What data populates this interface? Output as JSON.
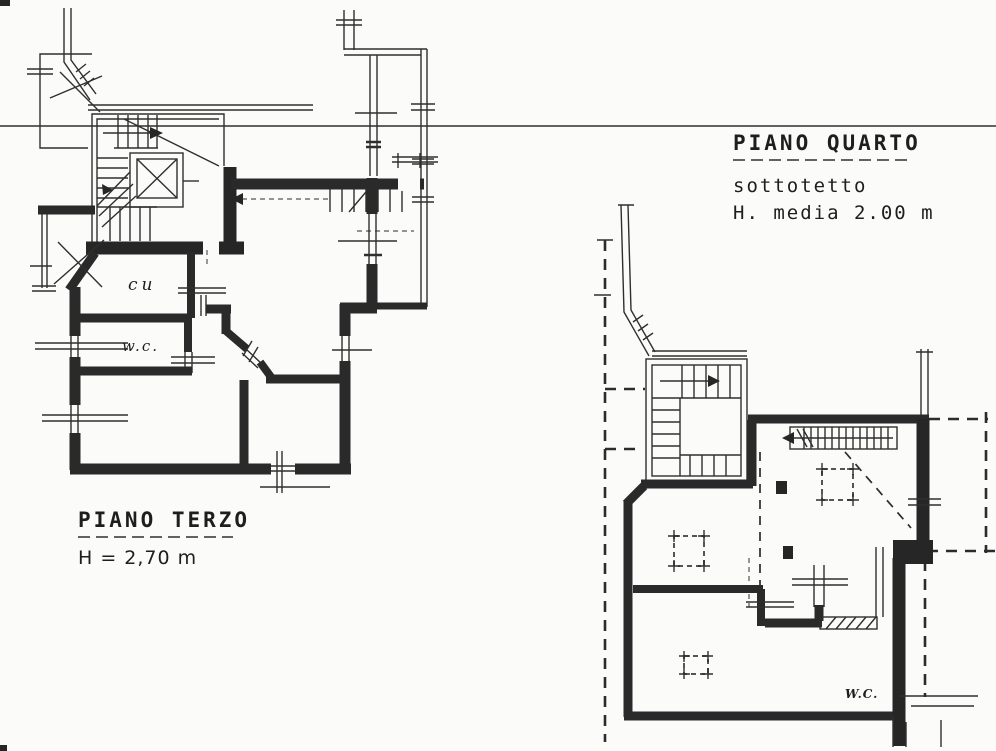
{
  "colors": {
    "paper": "#fbfbf9",
    "ink": "#2a2a2a"
  },
  "plans": {
    "terzo": {
      "title": "PIANO TERZO",
      "height_note": "H = 2,70 m",
      "labels": {
        "kitchen": "cu",
        "wc": "w.c."
      }
    },
    "quarto": {
      "title": "PIANO QUARTO",
      "subtitle": "sottotetto",
      "height_note": "H. media 2.00 m",
      "labels": {
        "wc": "W.C."
      }
    }
  }
}
